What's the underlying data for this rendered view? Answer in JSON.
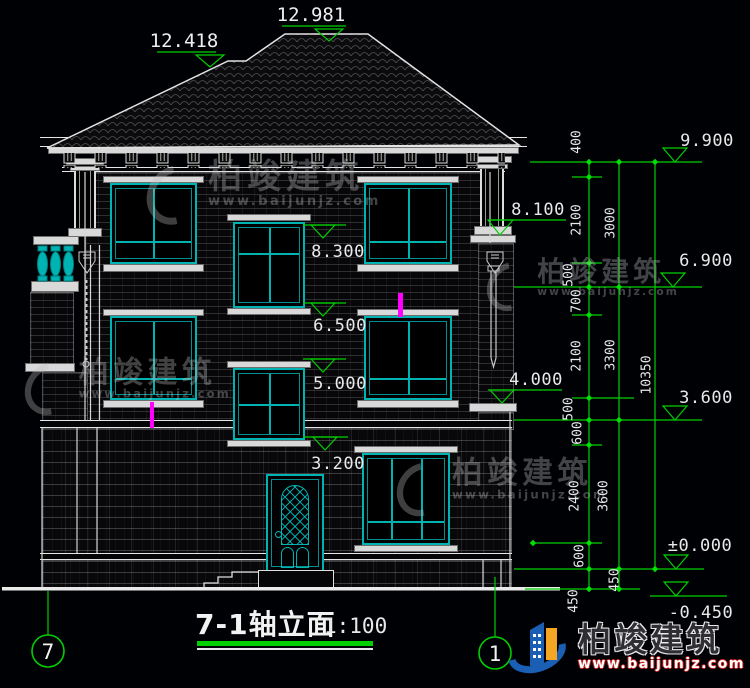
{
  "drawing": {
    "title": "7-1轴立面",
    "scale": "1:100",
    "axis_left": "7",
    "axis_right": "1"
  },
  "levels": {
    "roof": [
      "12.418",
      "12.981"
    ],
    "right": [
      "9.900",
      "6.900",
      "3.600",
      "±0.000",
      "-0.450"
    ],
    "facade": [
      "8.100",
      "4.000"
    ],
    "center": [
      "8.300",
      "6.500",
      "5.000",
      "3.200"
    ]
  },
  "dimensions": {
    "col1": [
      "400",
      "2100",
      "500",
      "700",
      "2100",
      "500",
      "600",
      "2400",
      "600",
      "450"
    ],
    "col2": [
      "3000",
      "3300",
      "3600",
      "450"
    ],
    "col3": [
      "10350"
    ]
  },
  "brand": {
    "name": "柏竣建筑",
    "website": "www.baijunjz.com"
  },
  "colors": {
    "line_green": "#00d000",
    "frame_cyan": "#00b3b3",
    "marker_magenta": "#ff00ff",
    "line_white": "#e9e9e9"
  }
}
